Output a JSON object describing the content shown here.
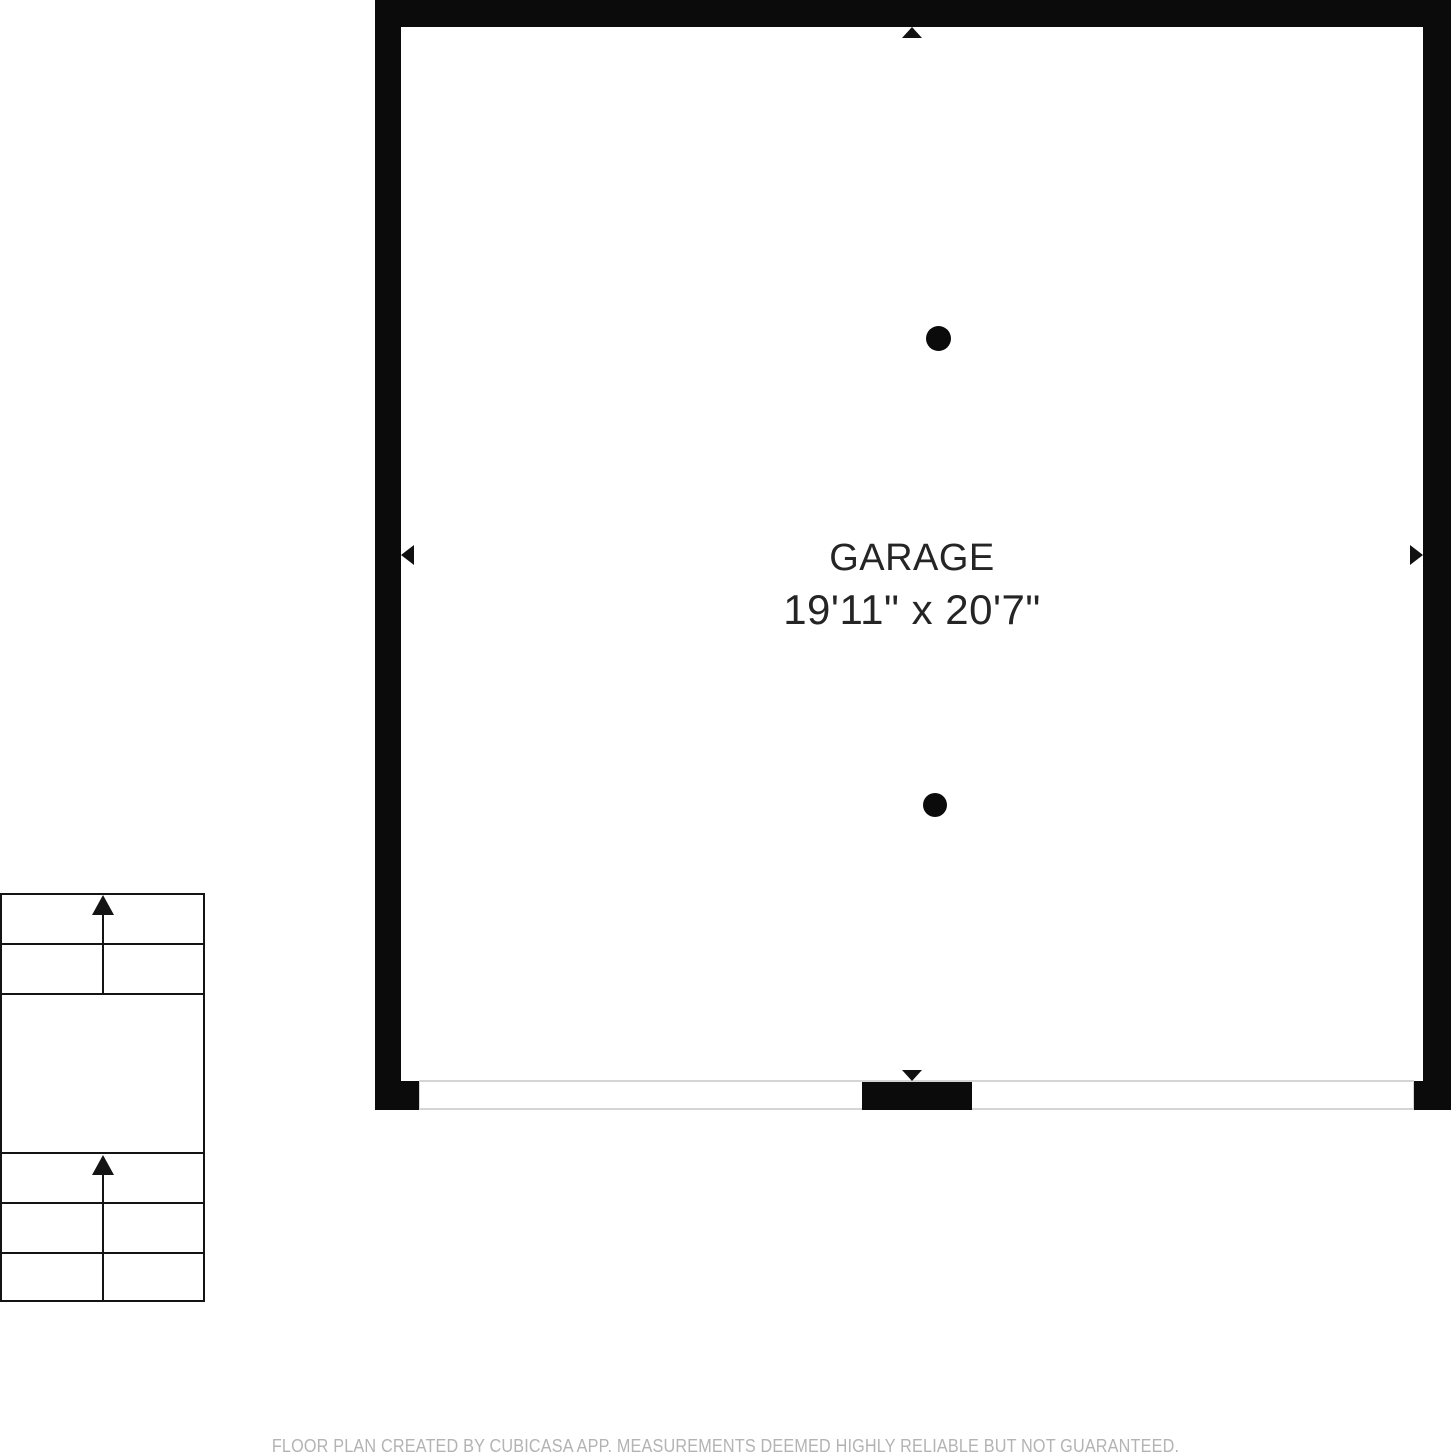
{
  "floor_plan": {
    "room": {
      "label": "GARAGE",
      "dimensions": "19'11\" x 20'7\""
    },
    "staircase": {
      "direction": "up",
      "upper_flight_steps": 2,
      "lower_flight_steps": 3
    },
    "icons": {
      "wall_markers": [
        "up-arrow",
        "left-arrow",
        "right-arrow",
        "down-arrow"
      ],
      "support_columns": 2,
      "stair_arrows": [
        "up-arrow",
        "up-arrow"
      ]
    },
    "colors": {
      "wall": "#0b0b0b",
      "stair_line": "#141414",
      "room_text": "#252525",
      "door_outline": "#d5d5d5",
      "footer_text": "#b3b3b3",
      "background": "#ffffff"
    }
  },
  "footer": {
    "disclaimer": "FLOOR PLAN CREATED BY CUBICASA APP. MEASUREMENTS DEEMED HIGHLY RELIABLE BUT NOT GUARANTEED."
  }
}
